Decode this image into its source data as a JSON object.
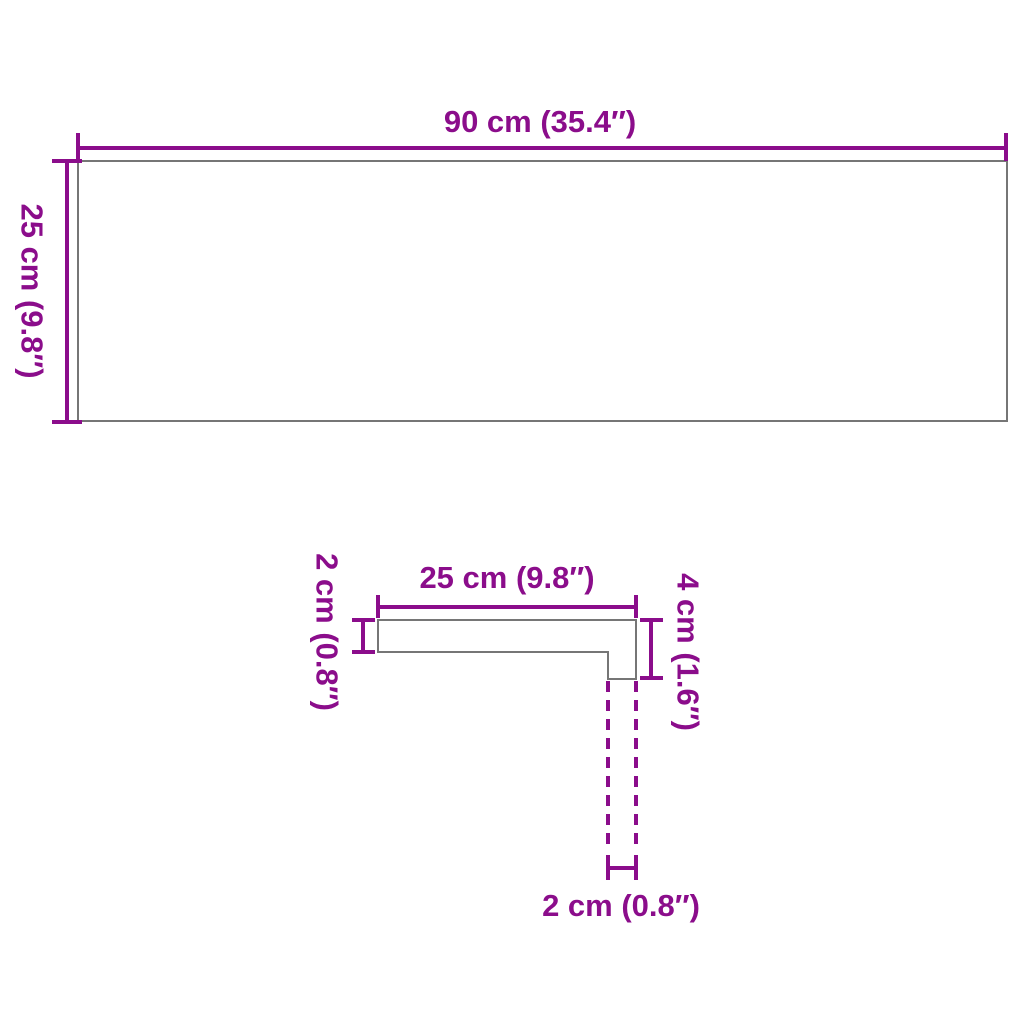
{
  "diagram": {
    "type": "product-dimension-drawing",
    "colors": {
      "dimension_accent": "#8b0d8b",
      "outline_gray": "#767676",
      "background": "#ffffff"
    },
    "top_view": {
      "width_label": "90 cm (35.4″)",
      "height_label": "25 cm (9.8″)"
    },
    "profile_view": {
      "top_width_label": "25 cm (9.8″)",
      "left_thickness_label": "2 cm (0.8″)",
      "right_height_label": "4 cm (1.6″)",
      "bottom_nosing_label": "2 cm (0.8″)"
    }
  }
}
